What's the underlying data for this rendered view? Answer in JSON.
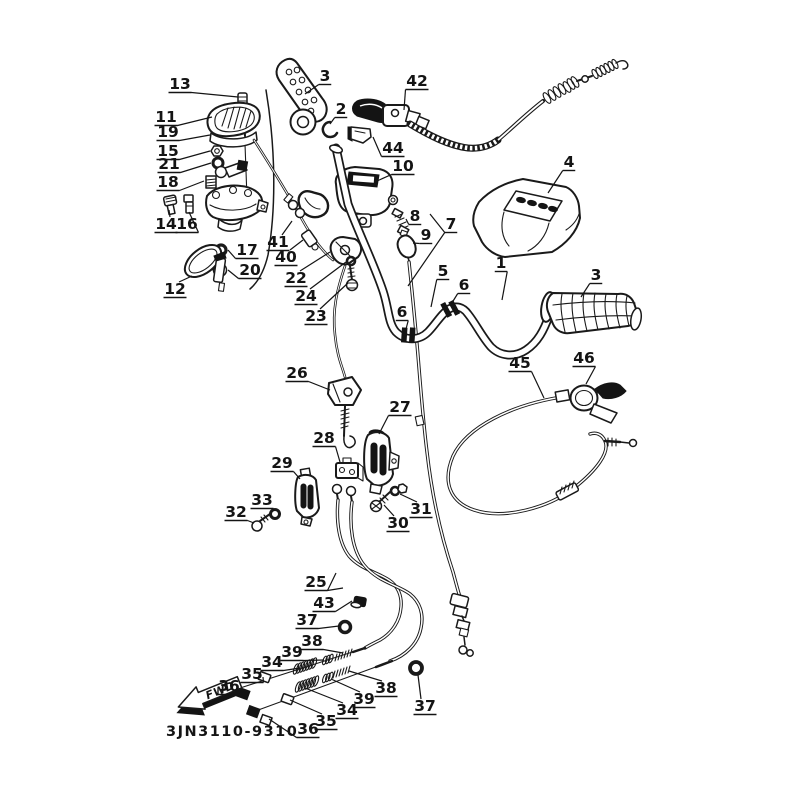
{
  "figure": {
    "part_number": "3JN3110-9310",
    "fwd_label": "FWD",
    "background_color": "#ffffff",
    "line_color": "#1a1a1a"
  },
  "callouts": [
    {
      "label": "13",
      "x": 180,
      "y": 84,
      "targets": [
        [
          238,
          97
        ]
      ]
    },
    {
      "label": "11",
      "x": 166,
      "y": 117,
      "targets": [
        [
          212,
          117
        ]
      ]
    },
    {
      "label": "19",
      "x": 168,
      "y": 132,
      "targets": [
        [
          210,
          135
        ]
      ]
    },
    {
      "label": "15",
      "x": 168,
      "y": 151,
      "targets": [
        [
          210,
          151
        ]
      ]
    },
    {
      "label": "21",
      "x": 169,
      "y": 164,
      "targets": [
        [
          211,
          163
        ]
      ]
    },
    {
      "label": "18",
      "x": 168,
      "y": 182,
      "targets": [
        [
          204,
          181
        ]
      ]
    },
    {
      "label": "14",
      "x": 166,
      "y": 224,
      "targets": [
        [
          169,
          210
        ]
      ]
    },
    {
      "label": "16",
      "x": 187,
      "y": 224,
      "targets": [
        [
          189,
          212
        ]
      ]
    },
    {
      "label": "17",
      "x": 247,
      "y": 250,
      "targets": [
        [
          228,
          250
        ]
      ]
    },
    {
      "label": "20",
      "x": 250,
      "y": 270,
      "targets": [
        [
          228,
          270
        ]
      ]
    },
    {
      "label": "12",
      "x": 175,
      "y": 289,
      "targets": [
        [
          192,
          276
        ]
      ]
    },
    {
      "label": "3",
      "x": 325,
      "y": 76,
      "targets": [
        [
          305,
          94
        ]
      ]
    },
    {
      "label": "2",
      "x": 341,
      "y": 109,
      "targets": [
        [
          330,
          124
        ]
      ]
    },
    {
      "label": "42",
      "x": 417,
      "y": 81,
      "targets": [
        [
          404,
          110
        ]
      ]
    },
    {
      "label": "44",
      "x": 393,
      "y": 148,
      "targets": [
        [
          373,
          137
        ]
      ]
    },
    {
      "label": "10",
      "x": 403,
      "y": 166,
      "targets": [
        [
          377,
          181
        ]
      ]
    },
    {
      "label": "41",
      "x": 278,
      "y": 242,
      "targets": [
        [
          292,
          221
        ]
      ]
    },
    {
      "label": "40",
      "x": 286,
      "y": 257,
      "targets": [
        [
          303,
          240
        ]
      ]
    },
    {
      "label": "22",
      "x": 296,
      "y": 278,
      "targets": [
        [
          330,
          252
        ]
      ]
    },
    {
      "label": "24",
      "x": 306,
      "y": 296,
      "targets": [
        [
          346,
          262
        ]
      ]
    },
    {
      "label": "23",
      "x": 316,
      "y": 316,
      "targets": [
        [
          348,
          283
        ]
      ]
    },
    {
      "label": "8",
      "x": 415,
      "y": 216,
      "targets": [
        [
          406,
          219
        ]
      ]
    },
    {
      "label": "9",
      "x": 426,
      "y": 235,
      "targets": [
        [
          413,
          243
        ]
      ]
    },
    {
      "label": "7",
      "x": 451,
      "y": 224,
      "targets": [
        [
          430,
          214
        ],
        [
          408,
          286
        ]
      ]
    },
    {
      "label": "5",
      "x": 443,
      "y": 271,
      "targets": [
        [
          431,
          307
        ]
      ]
    },
    {
      "label": "6",
      "x": 464,
      "y": 285,
      "targets": [
        [
          450,
          306
        ]
      ]
    },
    {
      "label": "6",
      "x": 402,
      "y": 312,
      "targets": [
        [
          406,
          329
        ]
      ]
    },
    {
      "label": "1",
      "x": 501,
      "y": 263,
      "targets": [
        [
          502,
          300
        ]
      ]
    },
    {
      "label": "4",
      "x": 569,
      "y": 162,
      "targets": [
        [
          548,
          193
        ]
      ]
    },
    {
      "label": "3",
      "x": 596,
      "y": 275,
      "targets": [
        [
          581,
          297
        ]
      ]
    },
    {
      "label": "45",
      "x": 520,
      "y": 363,
      "targets": [
        [
          544,
          398
        ]
      ]
    },
    {
      "label": "46",
      "x": 584,
      "y": 358,
      "targets": [
        [
          586,
          384
        ]
      ]
    },
    {
      "label": "26",
      "x": 297,
      "y": 373,
      "targets": [
        [
          330,
          390
        ]
      ]
    },
    {
      "label": "27",
      "x": 400,
      "y": 407,
      "targets": [
        [
          379,
          434
        ]
      ]
    },
    {
      "label": "28",
      "x": 324,
      "y": 438,
      "targets": [
        [
          340,
          462
        ]
      ]
    },
    {
      "label": "29",
      "x": 282,
      "y": 463,
      "targets": [
        [
          300,
          479
        ]
      ]
    },
    {
      "label": "33",
      "x": 262,
      "y": 500,
      "targets": [
        [
          274,
          511
        ]
      ]
    },
    {
      "label": "32",
      "x": 236,
      "y": 512,
      "targets": [
        [
          254,
          523
        ]
      ]
    },
    {
      "label": "30",
      "x": 398,
      "y": 523,
      "targets": [
        [
          384,
          505
        ]
      ]
    },
    {
      "label": "31",
      "x": 421,
      "y": 509,
      "targets": [
        [
          400,
          494
        ]
      ]
    },
    {
      "label": "25",
      "x": 316,
      "y": 582,
      "targets": [
        [
          336,
          573
        ],
        [
          343,
          588
        ]
      ]
    },
    {
      "label": "43",
      "x": 324,
      "y": 603,
      "targets": [
        [
          352,
          601
        ]
      ]
    },
    {
      "label": "37",
      "x": 307,
      "y": 620,
      "targets": [
        [
          339,
          626
        ]
      ]
    },
    {
      "label": "38",
      "x": 312,
      "y": 641,
      "targets": [
        [
          343,
          653
        ]
      ]
    },
    {
      "label": "39",
      "x": 292,
      "y": 652,
      "targets": [
        [
          324,
          660
        ]
      ]
    },
    {
      "label": "34",
      "x": 272,
      "y": 662,
      "targets": [
        [
          300,
          668
        ]
      ]
    },
    {
      "label": "35",
      "x": 252,
      "y": 674,
      "targets": [
        [
          263,
          677
        ]
      ]
    },
    {
      "label": "36",
      "x": 229,
      "y": 686,
      "targets": [
        [
          240,
          693
        ]
      ]
    },
    {
      "label": "38",
      "x": 386,
      "y": 688,
      "targets": [
        [
          349,
          671
        ]
      ]
    },
    {
      "label": "39",
      "x": 364,
      "y": 699,
      "targets": [
        [
          331,
          679
        ]
      ]
    },
    {
      "label": "34",
      "x": 347,
      "y": 710,
      "targets": [
        [
          305,
          688
        ]
      ]
    },
    {
      "label": "35",
      "x": 326,
      "y": 721,
      "targets": [
        [
          290,
          700
        ]
      ]
    },
    {
      "label": "36",
      "x": 308,
      "y": 729,
      "targets": [
        [
          269,
          719
        ]
      ]
    },
    {
      "label": "37",
      "x": 425,
      "y": 706,
      "targets": [
        [
          418,
          675
        ]
      ]
    }
  ]
}
